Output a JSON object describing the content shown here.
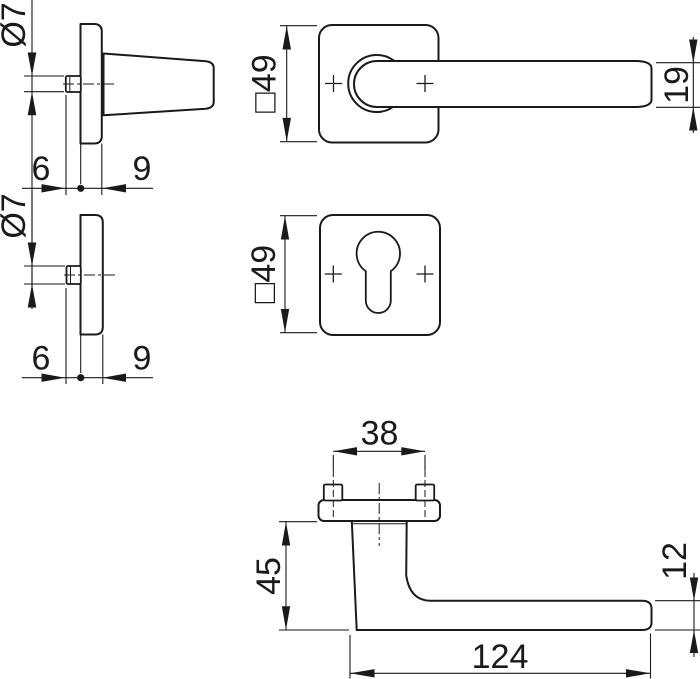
{
  "colors": {
    "line": "#1a1a1a",
    "background": "#ffffff"
  },
  "views": {
    "handle_side": {
      "spindle_diameter": "Ø7",
      "protrusion": "6",
      "rose_thickness": "9"
    },
    "handle_front": {
      "rose_size": "□49",
      "lever_height": "19"
    },
    "escutcheon_side": {
      "spindle_diameter": "Ø7",
      "protrusion": "6",
      "rose_thickness": "9"
    },
    "escutcheon_front": {
      "rose_size": "□49"
    },
    "handle_profile": {
      "screw_spacing": "38",
      "projection": "45",
      "lever_thickness": "12",
      "lever_length": "124"
    }
  }
}
